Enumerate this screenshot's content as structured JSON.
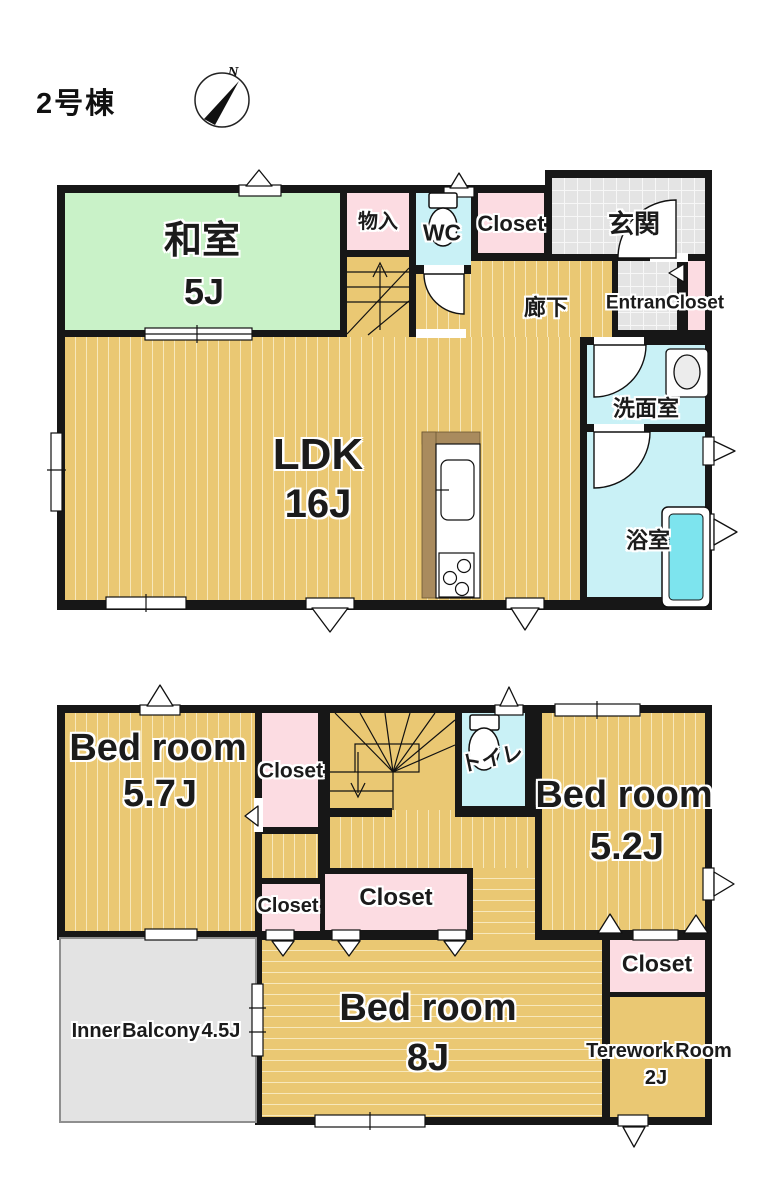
{
  "page": {
    "title": "2号棟",
    "compass_label": "N"
  },
  "colors": {
    "wall": "#171717",
    "wood": "#eac873",
    "wood_stripe": "#f7e8bb",
    "tatami_green": "#c9f2c8",
    "closet_pink": "#fcdce2",
    "wet_cyan": "#c9f1f6",
    "tile_gray": "#e4e4e4",
    "tub_cyan": "#7de4ee",
    "counter_brown": "#a98b5e",
    "balcony_gray": "#e3e3e3"
  },
  "floor1": {
    "washitsu": {
      "name": "和室",
      "size": "5J"
    },
    "monoire": {
      "name": "物入"
    },
    "wc": {
      "name": "WC"
    },
    "closet": {
      "name": "Closet"
    },
    "genkan": {
      "name": "玄関"
    },
    "entrance_closet": {
      "name": "EntranCloset"
    },
    "hallway": {
      "name": "廊下"
    },
    "ldk": {
      "name": "LDK",
      "size": "16J"
    },
    "washroom": {
      "name": "洗面室"
    },
    "bathroom": {
      "name": "浴室"
    }
  },
  "floor2": {
    "bedroom_57": {
      "name": "Bed room",
      "size": "5.7J"
    },
    "closet_a": {
      "name": "Closet"
    },
    "toilet": {
      "name": "トイレ"
    },
    "bedroom_52": {
      "name": "Bed room",
      "size": "5.2J"
    },
    "closet_b": {
      "name": "Closet"
    },
    "closet_c": {
      "name": "Closet"
    },
    "bedroom_8": {
      "name": "Bed room",
      "size": "8J"
    },
    "inner_balcony": {
      "name": "Inner Balcony 4.5J"
    },
    "closet_d": {
      "name": "Closet"
    },
    "telework": {
      "name": "Terework Room",
      "size": "2J"
    }
  }
}
